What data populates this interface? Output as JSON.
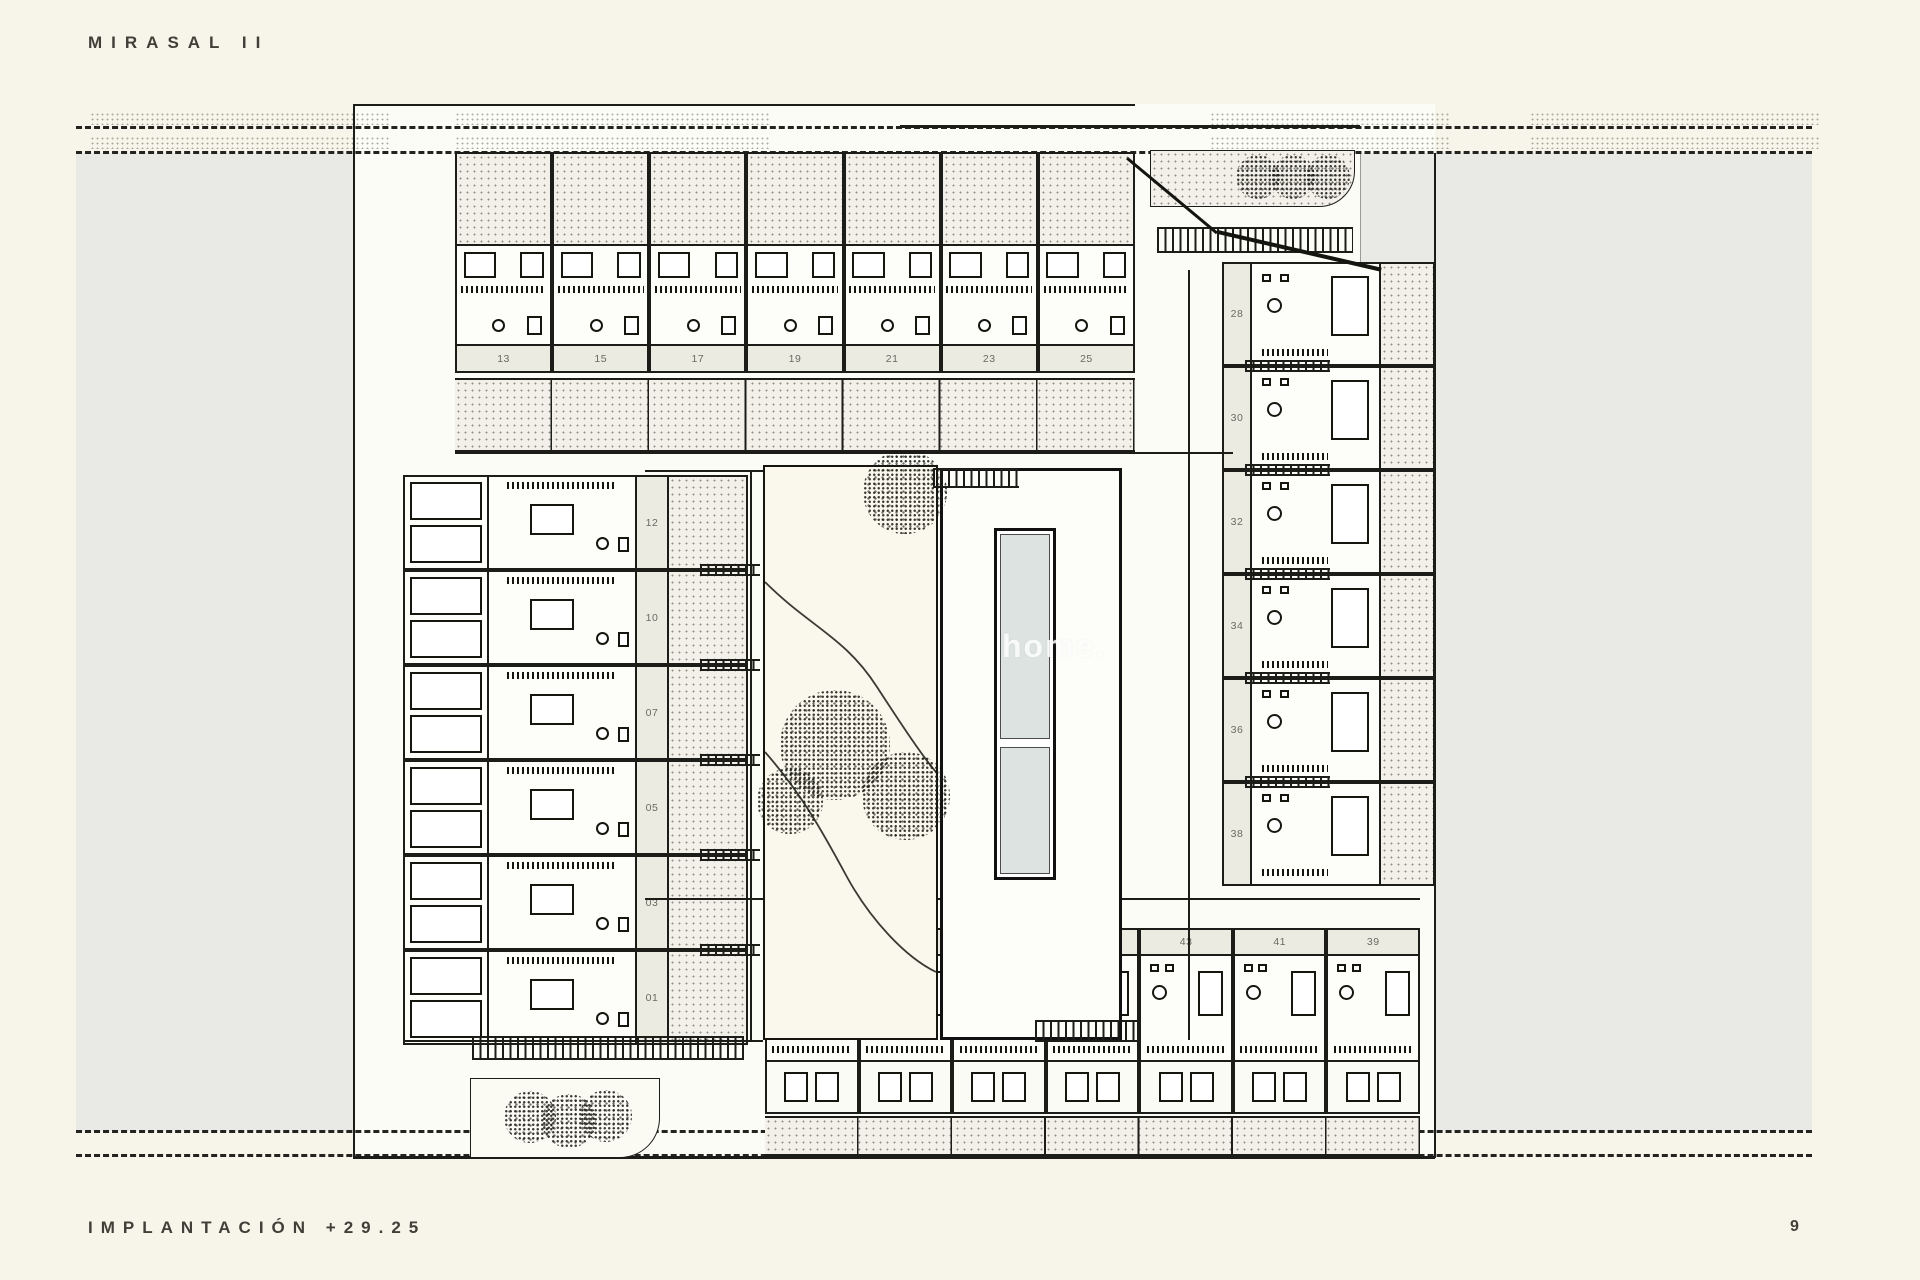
{
  "page": {
    "title": "MIRASAL II",
    "footer_label": "IMPLANTACIÓN +29.25",
    "page_number": "9",
    "watermark": "home.",
    "colors": {
      "paper": "#f7f5ea",
      "parcel_gray": "#e9e9e6",
      "line_ink": "#1c1c18",
      "pool_water": "#dce3e0",
      "unit_label_bg": "#ecebe2",
      "unit_label_text": "#6b6a62"
    }
  },
  "site_plan": {
    "units": {
      "top_row": [
        "13",
        "15",
        "17",
        "19",
        "21",
        "23",
        "25"
      ],
      "left_column": [
        "12",
        "10",
        "07",
        "05",
        "03",
        "01"
      ],
      "right_column": [
        "28",
        "30",
        "32",
        "34",
        "36",
        "38"
      ],
      "bottom_row": [
        "52",
        "50",
        "47",
        "45",
        "43",
        "41",
        "39"
      ]
    }
  }
}
